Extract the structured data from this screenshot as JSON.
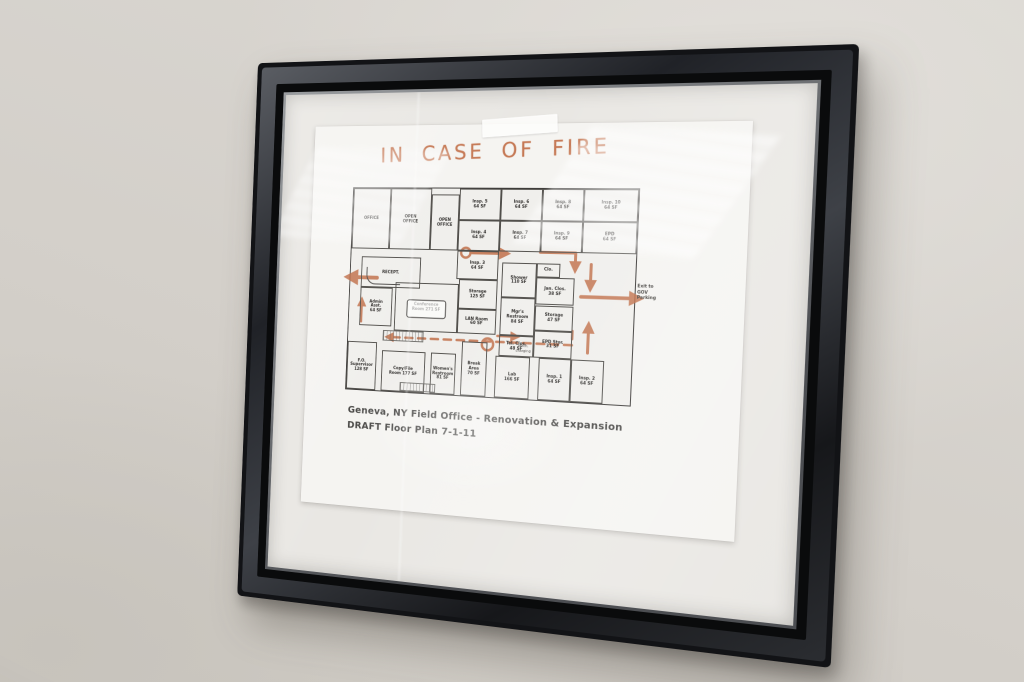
{
  "paper": {
    "title": "IN CASE OF FIRE",
    "title_color": "#c06b44",
    "caption_line1": "Geneva, NY Field Office - Renovation & Expansion",
    "caption_line2": "DRAFT Floor Plan 7-1-11"
  },
  "floor_plan": {
    "annotation_color": "#bf6a42",
    "exit_note": "Exit to\nGOV\nParking",
    "rooms": [
      {
        "id": "office",
        "label": "OFFICE",
        "x": 0,
        "y": 0,
        "w": 14,
        "h": 30
      },
      {
        "id": "open-office-1",
        "label": "OPEN\nOFFICE",
        "x": 14,
        "y": 0,
        "w": 15,
        "h": 30
      },
      {
        "id": "open-office-2",
        "label": "OPEN\nOFFICE",
        "x": 29,
        "y": 3,
        "w": 10,
        "h": 27
      },
      {
        "id": "insp-5",
        "label": "Insp. 5\n64 SF",
        "x": 39,
        "y": 0,
        "w": 14.5,
        "h": 15
      },
      {
        "id": "insp-6",
        "label": "Insp. 6\n64 SF",
        "x": 53.5,
        "y": 0,
        "w": 14.5,
        "h": 15
      },
      {
        "id": "insp-8",
        "label": "Insp. 8\n64 SF",
        "x": 68,
        "y": 0,
        "w": 14,
        "h": 15
      },
      {
        "id": "insp-10",
        "label": "Insp. 10\n64 SF",
        "x": 82,
        "y": 0,
        "w": 18,
        "h": 15
      },
      {
        "id": "insp-4",
        "label": "Insp. 4\n64 SF",
        "x": 39,
        "y": 15,
        "w": 14.5,
        "h": 15
      },
      {
        "id": "insp-7",
        "label": "Insp. 7\n64 SF",
        "x": 53.5,
        "y": 15,
        "w": 14.5,
        "h": 15
      },
      {
        "id": "insp-9",
        "label": "Insp. 9\n64 SF",
        "x": 68,
        "y": 15,
        "w": 14,
        "h": 15
      },
      {
        "id": "epd",
        "label": "EPD\n64 SF",
        "x": 82,
        "y": 15,
        "w": 18,
        "h": 15
      },
      {
        "id": "insp-3",
        "label": "Insp. 3\n64 SF",
        "x": 39,
        "y": 30,
        "w": 14.5,
        "h": 14
      },
      {
        "id": "reception",
        "label": "RECEPT.",
        "x": 4,
        "y": 34,
        "w": 22,
        "h": 15,
        "deco": "desk"
      },
      {
        "id": "admin-asst",
        "label": "Admin\nAsst.\n64 SF",
        "x": 4,
        "y": 49,
        "w": 12,
        "h": 19
      },
      {
        "id": "conference",
        "label": "Conference\nRoom 271 SF",
        "x": 17,
        "y": 46,
        "w": 23,
        "h": 24,
        "deco": "table"
      },
      {
        "id": "storage-125",
        "label": "Storage\n125 SF",
        "x": 40,
        "y": 44,
        "w": 13.5,
        "h": 14
      },
      {
        "id": "lan-room",
        "label": "LAN Room\n60 SF",
        "x": 40,
        "y": 58,
        "w": 13.5,
        "h": 12
      },
      {
        "id": "shower",
        "label": "Shower\n110 SF",
        "x": 55,
        "y": 35,
        "w": 12,
        "h": 17
      },
      {
        "id": "closet",
        "label": "Clo.",
        "x": 67,
        "y": 35,
        "w": 8,
        "h": 7
      },
      {
        "id": "jan-closet",
        "label": "Jan. Clos.\n38 SF",
        "x": 67,
        "y": 42,
        "w": 13,
        "h": 13
      },
      {
        "id": "storage-47",
        "label": "Storage\n47 SF",
        "x": 67,
        "y": 55,
        "w": 13,
        "h": 12
      },
      {
        "id": "mgr-restroom",
        "label": "Mgr's\nRestroom\n84 SF",
        "x": 55,
        "y": 52,
        "w": 12,
        "h": 18
      },
      {
        "id": "tel-closet",
        "label": "Tel. Clos.\n48 SF",
        "x": 55,
        "y": 70,
        "w": 12,
        "h": 10
      },
      {
        "id": "epd-storage",
        "label": "EPD Stor.\n31 SF",
        "x": 67,
        "y": 67,
        "w": 13,
        "h": 13
      },
      {
        "id": "fo-supervisor",
        "label": "F.O.\nSupervisor\n128 SF",
        "x": 0,
        "y": 76,
        "w": 11,
        "h": 24
      },
      {
        "id": "copy-file",
        "label": "Copy/File\nRoom 177 SF",
        "x": 13,
        "y": 80,
        "w": 16,
        "h": 20
      },
      {
        "id": "womens-restroom",
        "label": "Women's\nRestroom\n81 SF",
        "x": 31,
        "y": 80,
        "w": 9,
        "h": 20
      },
      {
        "id": "break-area",
        "label": "Break\nArea\n70 SF",
        "x": 42,
        "y": 74,
        "w": 9,
        "h": 26
      },
      {
        "id": "lab",
        "label": "Lab\n166 SF",
        "x": 54,
        "y": 80,
        "w": 12,
        "h": 20
      },
      {
        "id": "insp-1",
        "label": "Insp. 1\n64 SF",
        "x": 69,
        "y": 80,
        "w": 11,
        "h": 20
      },
      {
        "id": "insp-2",
        "label": "Insp. 2\n64 SF",
        "x": 80,
        "y": 80,
        "w": 11,
        "h": 20
      },
      {
        "id": "mech-charging",
        "label": "Mech.\ncharging",
        "x": 60.5,
        "y": 73,
        "w": 6,
        "h": 6,
        "cls": "open"
      },
      {
        "id": "stair-hatch",
        "label": "",
        "x": 13,
        "y": 70,
        "w": 15,
        "h": 5,
        "cls": "hatch"
      },
      {
        "id": "entry-hatch",
        "label": "",
        "x": 20,
        "y": 95,
        "w": 13,
        "h": 4.5,
        "cls": "hatch"
      }
    ],
    "annotations": [
      {
        "id": "exit-left-arrow",
        "points": [
          [
            30,
            93
          ],
          [
            -3,
            93
          ]
        ],
        "w": 4,
        "arrow": true
      },
      {
        "id": "left-up-arrow",
        "points": [
          [
            14,
            139
          ],
          [
            14,
            116
          ]
        ],
        "w": 2.5,
        "arrow": true
      },
      {
        "id": "corridor-loop",
        "type": "circle",
        "cx": 126,
        "cy": 65,
        "r": 5,
        "w": 2.5
      },
      {
        "id": "corridor-right-arrow",
        "points": [
          [
            133,
            65
          ],
          [
            170,
            65
          ]
        ],
        "w": 3,
        "arrow": true
      },
      {
        "id": "upper-right-elbow",
        "points": [
          [
            204,
            63
          ],
          [
            240,
            63
          ],
          [
            240,
            80
          ]
        ],
        "w": 3,
        "arrow": true
      },
      {
        "id": "right-down-arrow",
        "points": [
          [
            256,
            74
          ],
          [
            256,
            98
          ]
        ],
        "w": 3,
        "arrow": true
      },
      {
        "id": "exit-right-arrow",
        "points": [
          [
            247,
            106
          ],
          [
            305,
            106
          ]
        ],
        "w": 3.5,
        "arrow": true
      },
      {
        "id": "right-up-arrow",
        "points": [
          [
            256,
            161
          ],
          [
            256,
            133
          ]
        ],
        "w": 3,
        "arrow": true
      },
      {
        "id": "main-dashed-route",
        "points": [
          [
            240,
            140
          ],
          [
            240,
            154
          ],
          [
            44,
            154
          ]
        ],
        "dashed": true,
        "w": 2.5,
        "arrow": true
      },
      {
        "id": "route-swirl",
        "type": "circle",
        "cx": 153,
        "cy": 157,
        "r": 6,
        "w": 2.5
      },
      {
        "id": "swirl-right-arrow",
        "points": [
          [
            163,
            148
          ],
          [
            184,
            148
          ]
        ],
        "w": 2.5,
        "arrow": true
      }
    ]
  }
}
